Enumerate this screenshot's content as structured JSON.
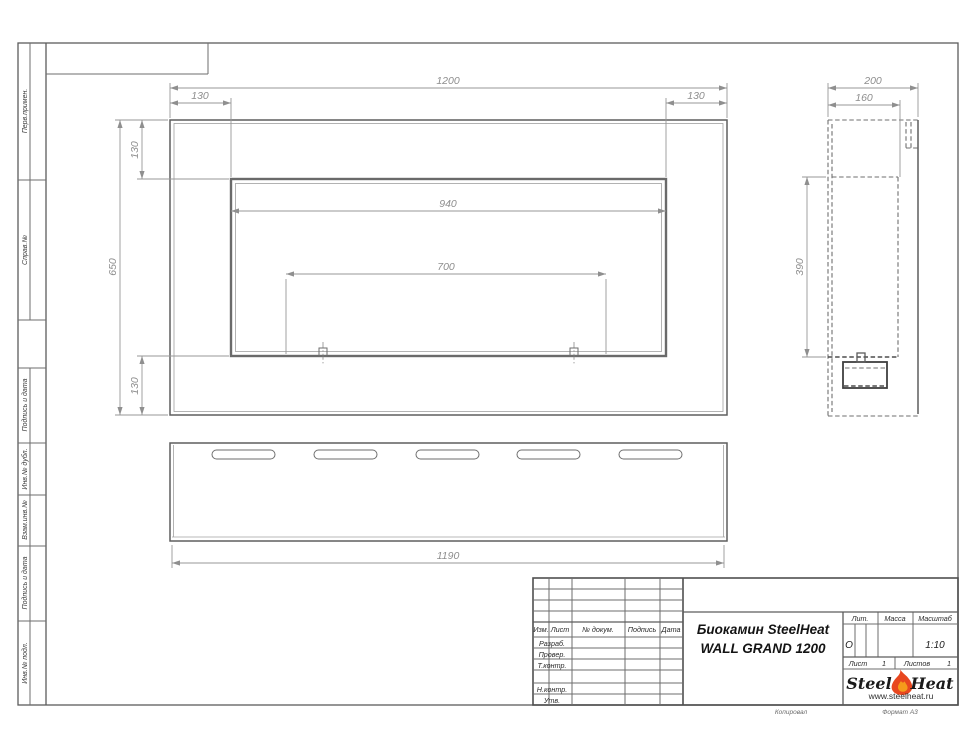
{
  "sheet": {
    "margin_labels": [
      "Перв.примен.",
      "Справ.№",
      "Подпись и дата",
      "Инв.№ дубл.",
      "Взам.инв.№",
      "Подпись и дата",
      "Инв.№ подл."
    ],
    "footer": {
      "copied": "Копировал",
      "format": "Формат А3"
    }
  },
  "drawing": {
    "front_view": {
      "width_total": "1200",
      "inset_left": "130",
      "inset_right": "130",
      "height_total": "650",
      "inset_top": "130",
      "inset_bottom": "130",
      "opening_width": "940",
      "burner_span": "700"
    },
    "side_view": {
      "depth_total": "200",
      "depth_inner": "160",
      "opening_height": "390"
    },
    "bottom_view": {
      "length_back": "1190"
    }
  },
  "title_block": {
    "columns": [
      "Изм.",
      "Лист",
      "№ докум.",
      "Подпись",
      "Дата"
    ],
    "rows": [
      "Разраб.",
      "Провер.",
      "Т.контр.",
      "Н.контр.",
      "Утв."
    ],
    "title_line1": "Биокамин SteelHeat",
    "title_line2": "WALL GRAND 1200",
    "lit": {
      "label": "Лит.",
      "value": "О"
    },
    "mass": {
      "label": "Масса",
      "value": ""
    },
    "scale": {
      "label": "Масштаб",
      "value": "1:10"
    },
    "sheet_no": {
      "label": "Лист",
      "value": "1"
    },
    "sheets_total": {
      "label": "Листов",
      "value": "1"
    },
    "logo": {
      "text1": "Steel",
      "text2": "Heat",
      "website": "www.steelheat.ru",
      "flame_icon": "flame-icon",
      "flame_color": "#e8471f",
      "flame_inner": "#f59b1b"
    }
  }
}
